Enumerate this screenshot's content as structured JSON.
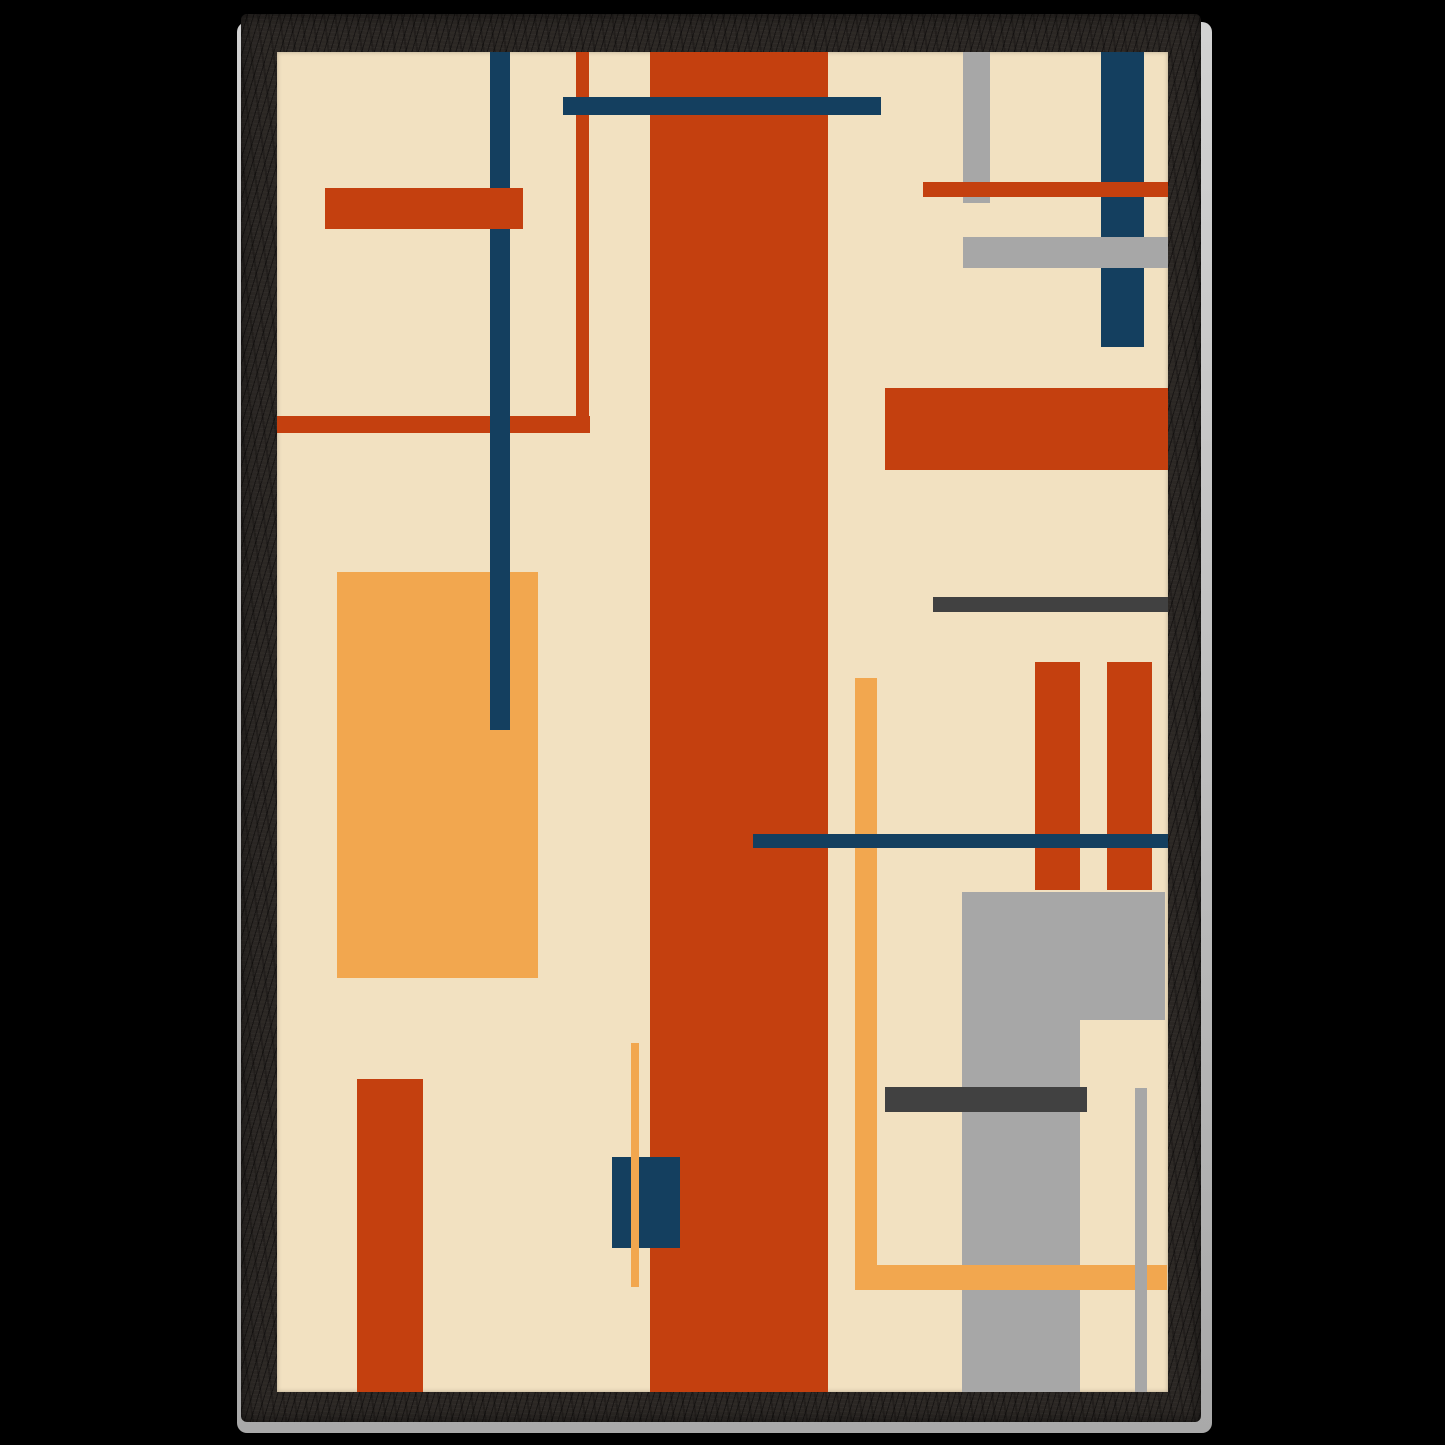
{
  "artwork": {
    "title": "Abstract geometric composition, Bauhaus-style framed art print",
    "background_color": "#000000",
    "frame": {
      "style": "black-wood-frame",
      "wood_color": "#2b2724",
      "edge_highlight_color": "#c4c4c4"
    },
    "canvas": {
      "background": "#f2e1c1",
      "width": 891,
      "height": 1340
    },
    "palette": {
      "rust": "#c4400f",
      "navy": "#143f5f",
      "amber": "#f2a74f",
      "gray": "#a7a7a7",
      "dark_gray": "#414141",
      "cream": "#f2e1c1"
    },
    "shapes": [
      {
        "name": "amber-rect-left",
        "color": "#f2a74f",
        "x": 60,
        "y": 520,
        "w": 201,
        "h": 406
      },
      {
        "name": "rust-hline-left",
        "color": "#c4400f",
        "x": 0,
        "y": 364,
        "w": 313,
        "h": 17
      },
      {
        "name": "rust-vline-topleft",
        "color": "#c4400f",
        "x": 299,
        "y": 0,
        "w": 13,
        "h": 381
      },
      {
        "name": "navy-vline-left",
        "color": "#143f5f",
        "x": 213,
        "y": 0,
        "w": 20,
        "h": 678
      },
      {
        "name": "rust-rect-topleft",
        "color": "#c4400f",
        "x": 48,
        "y": 136,
        "w": 198,
        "h": 41
      },
      {
        "name": "rust-central-bar",
        "color": "#c4400f",
        "x": 373,
        "y": 0,
        "w": 178,
        "h": 1340
      },
      {
        "name": "navy-hbar-top",
        "color": "#143f5f",
        "x": 286,
        "y": 45,
        "w": 318,
        "h": 18
      },
      {
        "name": "gray-vbar-topright",
        "color": "#a7a7a7",
        "x": 686,
        "y": 0,
        "w": 27,
        "h": 151
      },
      {
        "name": "navy-vbar-topright",
        "color": "#143f5f",
        "x": 824,
        "y": 0,
        "w": 43,
        "h": 295
      },
      {
        "name": "rust-hline-topright",
        "color": "#c4400f",
        "x": 646,
        "y": 130,
        "w": 245,
        "h": 15
      },
      {
        "name": "gray-hbar-topright",
        "color": "#a7a7a7",
        "x": 686,
        "y": 185,
        "w": 205,
        "h": 31
      },
      {
        "name": "rust-rect-right",
        "color": "#c4400f",
        "x": 608,
        "y": 336,
        "w": 283,
        "h": 82
      },
      {
        "name": "darkgray-line-right",
        "color": "#414141",
        "x": 656,
        "y": 545,
        "w": 235,
        "h": 15
      },
      {
        "name": "rust-bar-right-1",
        "color": "#c4400f",
        "x": 758,
        "y": 610,
        "w": 45,
        "h": 228
      },
      {
        "name": "rust-bar-right-2",
        "color": "#c4400f",
        "x": 830,
        "y": 610,
        "w": 45,
        "h": 228
      },
      {
        "name": "amber-vline-right",
        "color": "#f2a74f",
        "x": 578,
        "y": 626,
        "w": 22,
        "h": 612
      },
      {
        "name": "navy-hline-right",
        "color": "#143f5f",
        "x": 476,
        "y": 782,
        "w": 415,
        "h": 14
      },
      {
        "name": "gray-rect-right-big",
        "color": "#a7a7a7",
        "x": 685,
        "y": 840,
        "w": 203,
        "h": 128
      },
      {
        "name": "gray-column-right",
        "color": "#a7a7a7",
        "x": 685,
        "y": 968,
        "w": 118,
        "h": 372
      },
      {
        "name": "darkgray-bar-bottomright",
        "color": "#414141",
        "x": 608,
        "y": 1035,
        "w": 202,
        "h": 25
      },
      {
        "name": "amber-hbar-bottomright",
        "color": "#f2a74f",
        "x": 578,
        "y": 1213,
        "w": 312,
        "h": 25
      },
      {
        "name": "gray-thin-vline-bottomright",
        "color": "#a7a7a7",
        "x": 858,
        "y": 1036,
        "w": 12,
        "h": 304
      },
      {
        "name": "navy-square-bottom",
        "color": "#143f5f",
        "x": 335,
        "y": 1105,
        "w": 68,
        "h": 91
      },
      {
        "name": "amber-thin-vline-center",
        "color": "#f2a74f",
        "x": 354,
        "y": 991,
        "w": 8,
        "h": 244
      },
      {
        "name": "rust-bar-bottomleft",
        "color": "#c4400f",
        "x": 80,
        "y": 1027,
        "w": 66,
        "h": 313
      }
    ]
  }
}
